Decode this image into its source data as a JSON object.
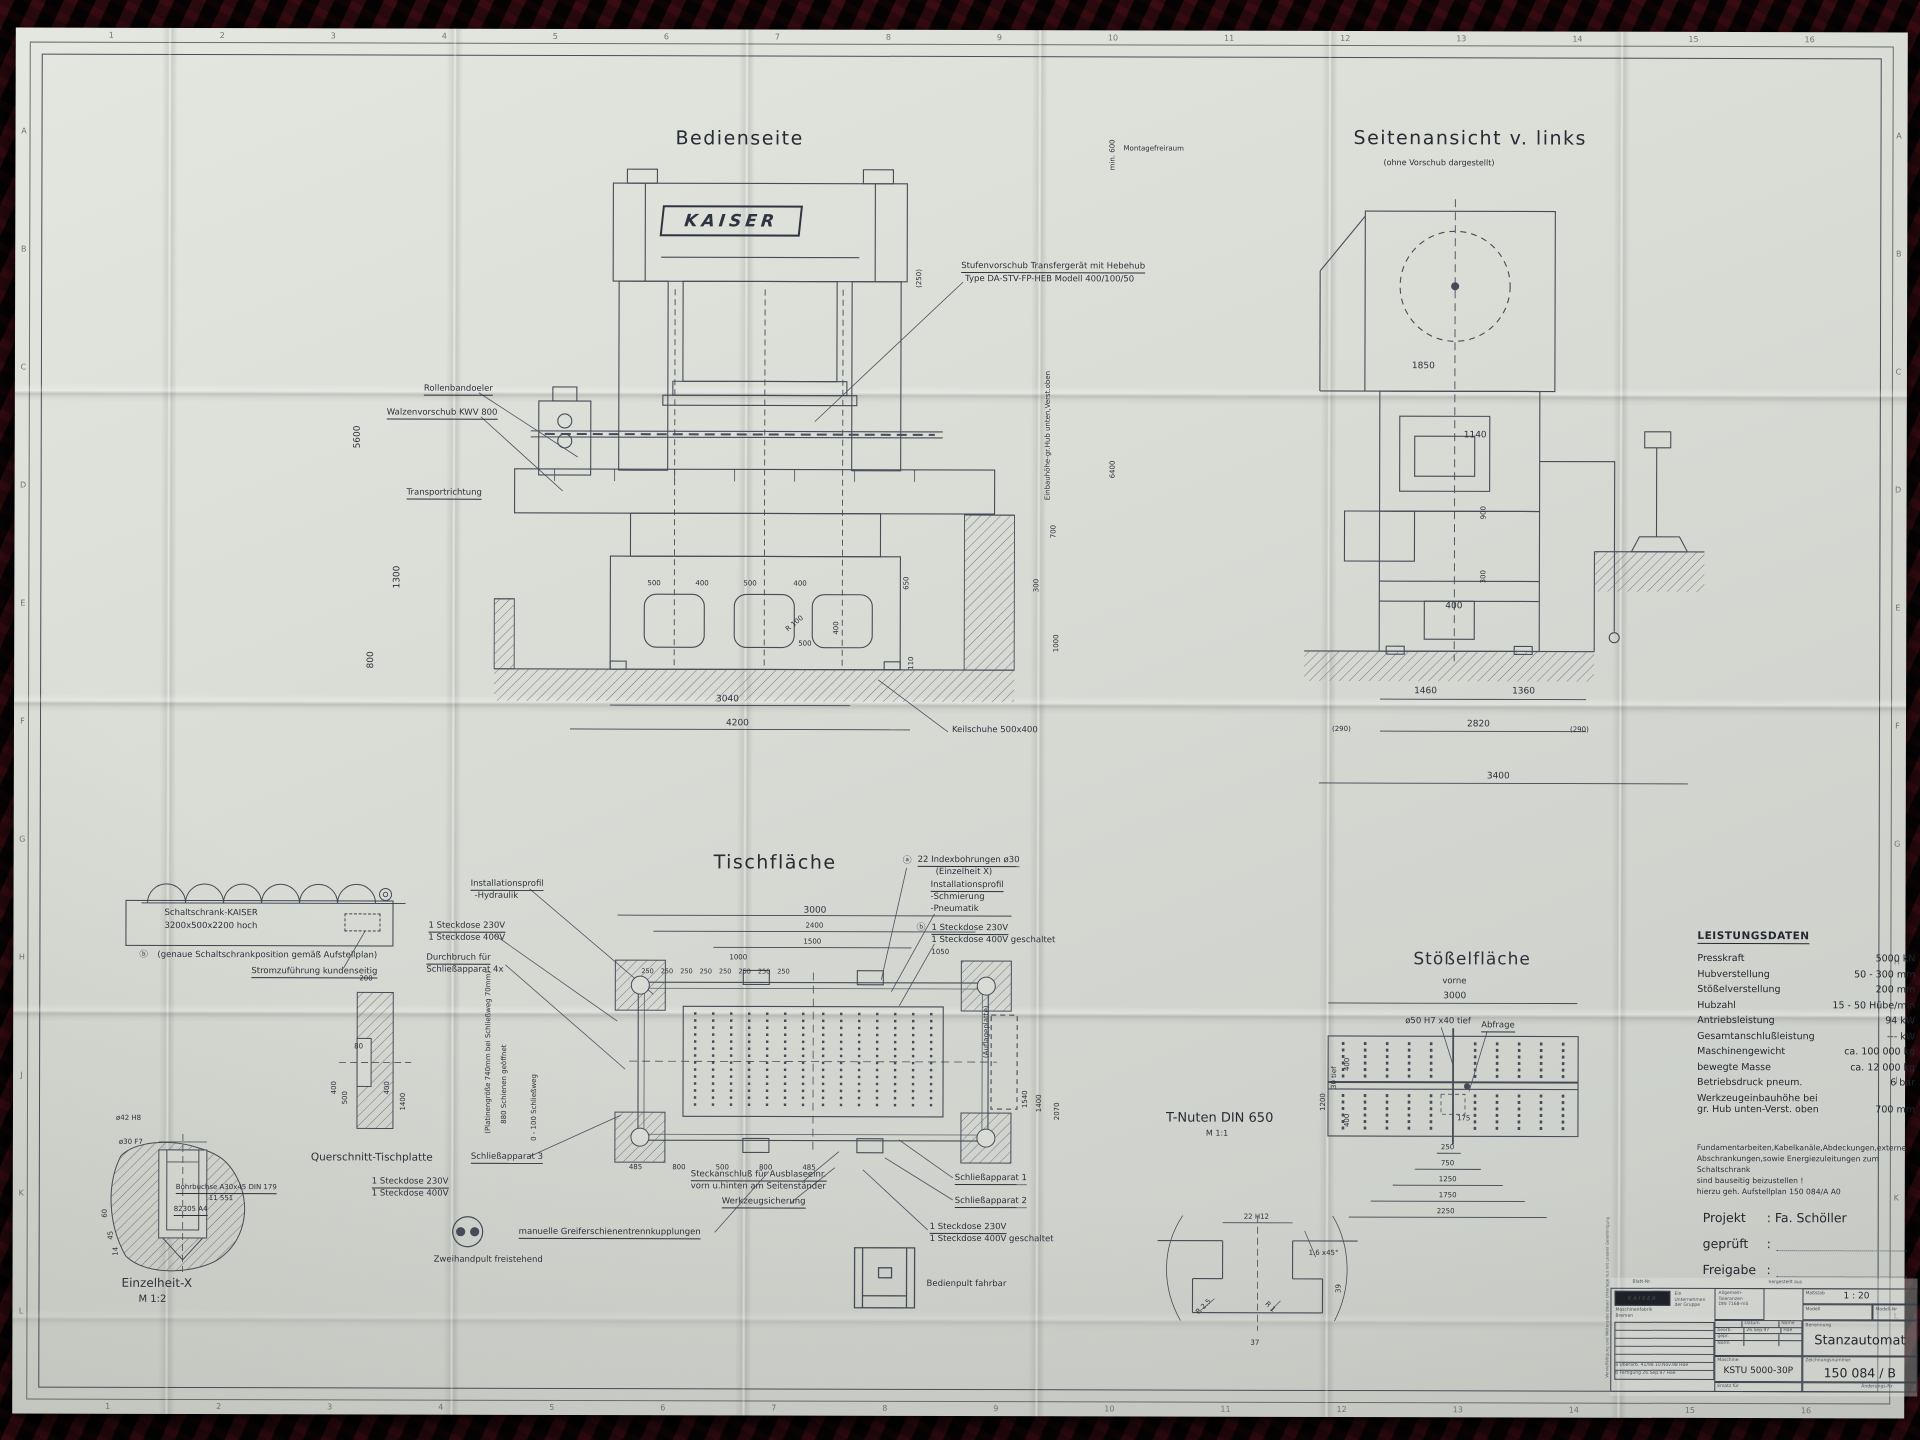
{
  "frame": {
    "cols": [
      "1",
      "2",
      "3",
      "4",
      "5",
      "6",
      "7",
      "8",
      "9",
      "10",
      "11",
      "12",
      "13",
      "14",
      "15",
      "16"
    ],
    "rows": [
      "A",
      "B",
      "C",
      "D",
      "E",
      "F",
      "G",
      "H",
      "J",
      "K",
      "L"
    ]
  },
  "bedienseite": {
    "title": "Bedienseite",
    "brand": "KAISER",
    "labels": {
      "montagefreiraum": "Montagefreiraum",
      "min600": "min. 600",
      "stufen1": "Stufenvorschub Transfergerät mit Hebehub",
      "stufen2": "Type DA-STV-FP-HEB   Modell 400/100/50",
      "rollenbandoeler": "Rollenbandoeler",
      "walzenvorschub": "Walzenvorschub KWV 800",
      "transportrichtung": "Transportrichtung",
      "keilschuhe": "Keilschuhe 500x400",
      "einbauhoehe": "Einbauhöhe-gr.Hub unten,Verst.oben"
    },
    "dims": {
      "d5600": "5600",
      "d1300": "1300",
      "d800": "800",
      "d500a": "500",
      "d400a": "400",
      "d500b": "500",
      "d400b": "400",
      "r100": "R 100",
      "d400c": "400",
      "d500c": "500",
      "d3040": "3040",
      "d4200": "4200",
      "d250p": "(250)",
      "d6400": "6400",
      "d650": "650",
      "d700": "700",
      "d300": "300",
      "d1000": "1000",
      "d110": "110"
    }
  },
  "seitenansicht": {
    "title": "Seitenansicht v. links",
    "subtitle": "(ohne Vorschub dargestellt)",
    "dims": {
      "d1850": "1850",
      "d1140": "1140",
      "d900": "900",
      "d300": "300",
      "d400": "400",
      "d1460": "1460",
      "d1360": "1360",
      "d2820": "2820",
      "d290l": "(290)",
      "d290r": "(290)",
      "d3400": "3400"
    }
  },
  "tischflaeche": {
    "title": "Tischfläche",
    "labels": {
      "instprofil_l1": "Installationsprofil",
      "instprofil_l2": "-Hydraulik",
      "steckdose230": "1 Steckdose 230V",
      "steckdose400": "1 Steckdose 400V",
      "durchbruch1": "Durchbruch für",
      "durchbruch2": "Schließapparat 4x",
      "platinen": "(Platinengröße 740mm bei Schließweg 70mm)",
      "schienen": "880 Schienen geöffnet",
      "schliessweg": "0 - 100 Schließweg",
      "app3": "Schließapparat 3",
      "steckdose230b": "1 Steckdose 230V",
      "steckdose400b": "1 Steckdose 400V",
      "zweihand": "Zweihandpult freistehend",
      "greifer": "manuelle Greiferschienentrennkupplungen",
      "werkzeug": "Werkzeugsicherung",
      "steckanschluss1": "Steckanschluß für Ausblaseeinr.",
      "steckanschluss2": "vorn u.hinten am Seitenständer",
      "index_mark": "ⓐ",
      "index1": "22 Indexbohrungen ø30",
      "index2": "(Einzelheit X)",
      "instprofil_r1": "Installationsprofil",
      "instprofil_r2": "-Schmierung",
      "instprofil_r3": "-Pneumatik",
      "steck_mark": "ⓑ",
      "steckdose230c": "1 Steckdose 230V",
      "steckdose400g": "1 Steckdose 400V geschaltet",
      "app1": "Schließapparat 1",
      "app2": "Schließapparat 2",
      "steckdose230d": "1 Steckdose 230V",
      "steckdose400g2": "1 Steckdose 400V geschaltet",
      "bedienpult": "Bedienpult fahrbar",
      "auflageplatte": "(Auflageplatte)"
    },
    "dims": {
      "d3000": "3000",
      "d2400": "2400",
      "d1500": "1500",
      "d1000": "1000",
      "d1050": "1050",
      "d250row": [
        "250",
        "250",
        "250",
        "250",
        "250",
        "250",
        "250",
        "250"
      ],
      "bottom": [
        "485",
        "800",
        "500",
        "800",
        "485"
      ],
      "d1540": "1540",
      "d1400": "1400",
      "d2070": "2070"
    }
  },
  "schaltschrank": {
    "line1": "Schaltschrank-KAISER",
    "line2": "3200x500x2200 hoch",
    "mark": "ⓑ",
    "note": "(genaue Schaltschrankposition gemäß Aufstellplan)",
    "strom": "Stromzuführung kundenseitig"
  },
  "querschnitt": {
    "title": "Querschnitt-Tischplatte",
    "dims": {
      "d200": "200",
      "d80": "80",
      "d500": "500",
      "d400l": "400",
      "d400r": "400",
      "d1400": "1400"
    }
  },
  "einzelheit": {
    "title": "Einzelheit-X",
    "scale": "M 1:2",
    "labels": {
      "d42": "ø42 H8",
      "d30": "ø30 F7",
      "bohrbuchse": "Bohrbuchse A30x45 DIN 179",
      "num": "11 551",
      "pos": "82305 A4"
    },
    "dims": {
      "d60": "60",
      "d45": "45",
      "d14": "14"
    }
  },
  "tnuten": {
    "title": "T-Nuten DIN 650",
    "scale": "M 1:1",
    "dims": {
      "d22": "22 H12",
      "chamfer": "1.6 x45°",
      "r25": "R 2.5",
      "r1": "R 1",
      "d39": "39",
      "d37": "37"
    }
  },
  "stoesselflaeche": {
    "title": "Stößelfläche",
    "labels": {
      "vorne": "vorne",
      "bohr": "ø50 H7 x40 tief",
      "abfrage": "Abfrage",
      "tief30": "30 tief"
    },
    "dims": {
      "d3000": "3000",
      "d400t": "400",
      "d400b": "400",
      "d175": "175",
      "d250": "250",
      "d750": "750",
      "d1250": "1250",
      "d1750": "1750",
      "d2250": "2250",
      "d1200": "1200"
    }
  },
  "leistungsdaten": {
    "title": "LEISTUNGSDATEN",
    "rows": [
      {
        "label": "Presskraft",
        "value": "5000 kN"
      },
      {
        "label": "Hubverstellung",
        "value": "50 - 300 mm"
      },
      {
        "label": "Stößelverstellung",
        "value": "200 mm"
      },
      {
        "label": "Hubzahl",
        "value": "15 - 50  Hübe/min"
      },
      {
        "label": "Antriebsleistung",
        "value": "94 kW"
      },
      {
        "label": "Gesamtanschlußleistung",
        "value": "--- kW"
      },
      {
        "label": "Maschinengewicht",
        "value": "ca. 100 000 kg"
      },
      {
        "label": "bewegte Masse",
        "value": "ca. 12 000 kg"
      },
      {
        "label": "Betriebsdruck pneum.",
        "value": "6 bar"
      },
      {
        "label": "Werkzeugeinbauhöhe bei\ngr. Hub unten-Verst. oben",
        "value": "700 mm"
      }
    ]
  },
  "note": {
    "l1": "Fundamentarbeiten,Kabelkanäle,Abdeckungen,externe",
    "l2": "Abschrankungen,sowie Energiezuleitungen zum Schaltschrank",
    "l3": "sind bauseitig beizustellen !",
    "l4": "hierzu geh. Aufstellplan 150 084/A  A0"
  },
  "project": {
    "projekt": "Projekt",
    "projekt_v": ": Fa. Schöller",
    "geprueft": "geprüft",
    "freigabe": "Freigabe",
    "colon": ":"
  },
  "titleblock": {
    "blatt": "Blatt-Nr.",
    "hergestellt": "hergestellt aus",
    "logo": "KAISER",
    "firm1": "Maschinenfabrik",
    "firm2": "Bremen",
    "unternehmen": "Ein Unternehmen der Gruppe",
    "toleranz1": "Allgemein-",
    "toleranz2": "Toleranzen",
    "toleranz3": "DIN 7168-mS",
    "datum": "Datum",
    "name": "Name",
    "bearb": "bearb.",
    "bearb_d": "26.Sep.97",
    "bearb_n": "Hae",
    "gepr": "gepr.",
    "norm": "Norm",
    "massstab_l": "Maßstab",
    "massstab": "1 : 20",
    "modell": "Modell",
    "modellnr": "Modell-Nr",
    "benennung_l": "Benennung",
    "benennung": "Stanzautomat",
    "maschine_l": "Maschine",
    "maschine": "KSTU 5000-30P",
    "zeichnung_l": "Zeichnungsnummer",
    "zeichnung": "150 084 / B",
    "ersatz": "Ersatz für",
    "aenderung": "Änderungs-Nr",
    "rev1": "a  Überarb. 41/98    10.Nov.98   Hae",
    "rev2": "b  Fertigung         26.Sep.97   Hae",
    "copyright": "Vervielfältigung und Weitergabe dieser Unterlage nur mit unserer Genehmigung"
  }
}
